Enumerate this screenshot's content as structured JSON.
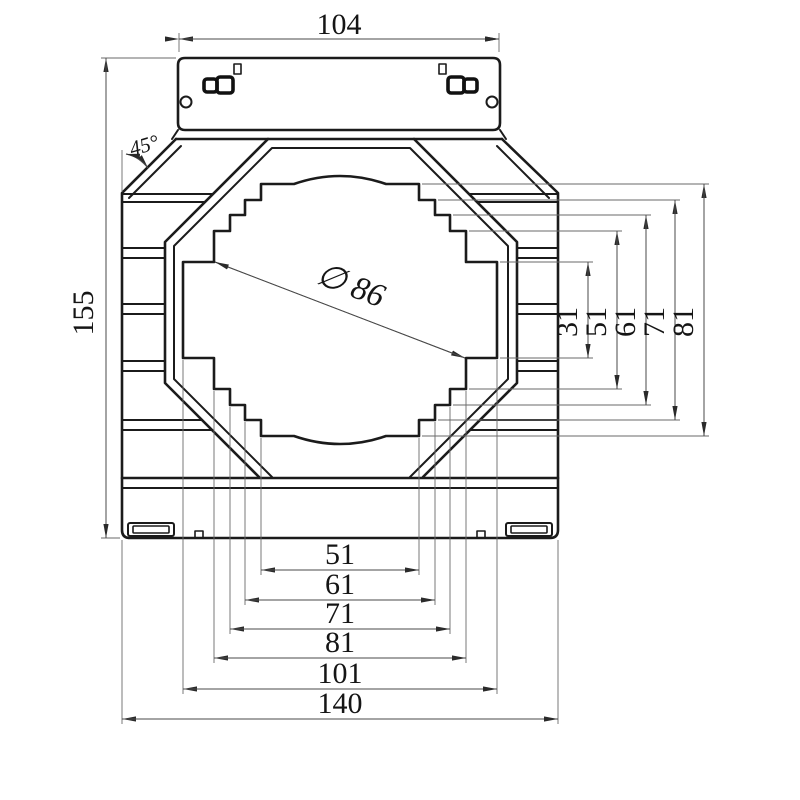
{
  "drawing": {
    "dimensions": {
      "top_width": "104",
      "overall_height": "155",
      "chamfer_angle": "45°",
      "aperture_diameter": "∅ 86",
      "right_vertical": [
        "31",
        "51",
        "61",
        "71",
        "81"
      ],
      "bottom_horizontal": [
        "51",
        "61",
        "71",
        "81",
        "101",
        "140"
      ]
    },
    "colors": {
      "line": "#1b1b1b",
      "thin_line": "#4a4a4a",
      "background": "#ffffff"
    }
  }
}
